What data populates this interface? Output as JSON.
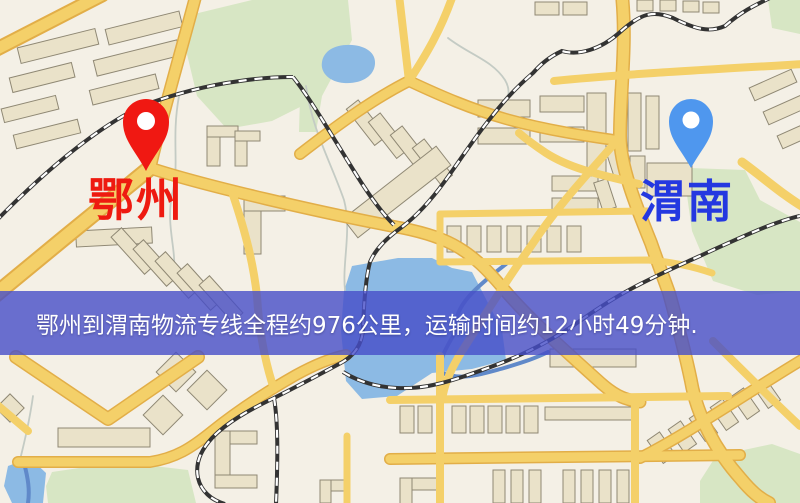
{
  "window": {
    "width": 800,
    "height": 503
  },
  "map": {
    "markers": [
      {
        "id": "origin",
        "label": "鄂州",
        "pin": "red-map-pin",
        "pin_color_key": "pin_red"
      },
      {
        "id": "destination",
        "label": "渭南",
        "pin": "blue-map-pin",
        "pin_color_key": "pin_blue"
      }
    ]
  },
  "banner": {
    "text": "鄂州到渭南物流专线全程约976公里，运输时间约12小时49分钟."
  },
  "colors": {
    "map_bg": "#f4f0e6",
    "road_fill": "#f4d069",
    "road_casing": "#e2ae48",
    "building_fill": "#eae2c9",
    "building_stroke": "#8f8874",
    "green": "#d7e6c4",
    "water": "#8cbae4",
    "water_deep": "#6089c9",
    "railway_dark": "#333333",
    "stream": "#c4cbc4",
    "pin_red": "#f01812",
    "pin_blue": "#4f97ee",
    "label_red": "#ee1a10",
    "label_blue": "#2438e0",
    "banner_bg": "rgba(70,77,200,0.8)",
    "banner_text": "#ffffff"
  }
}
